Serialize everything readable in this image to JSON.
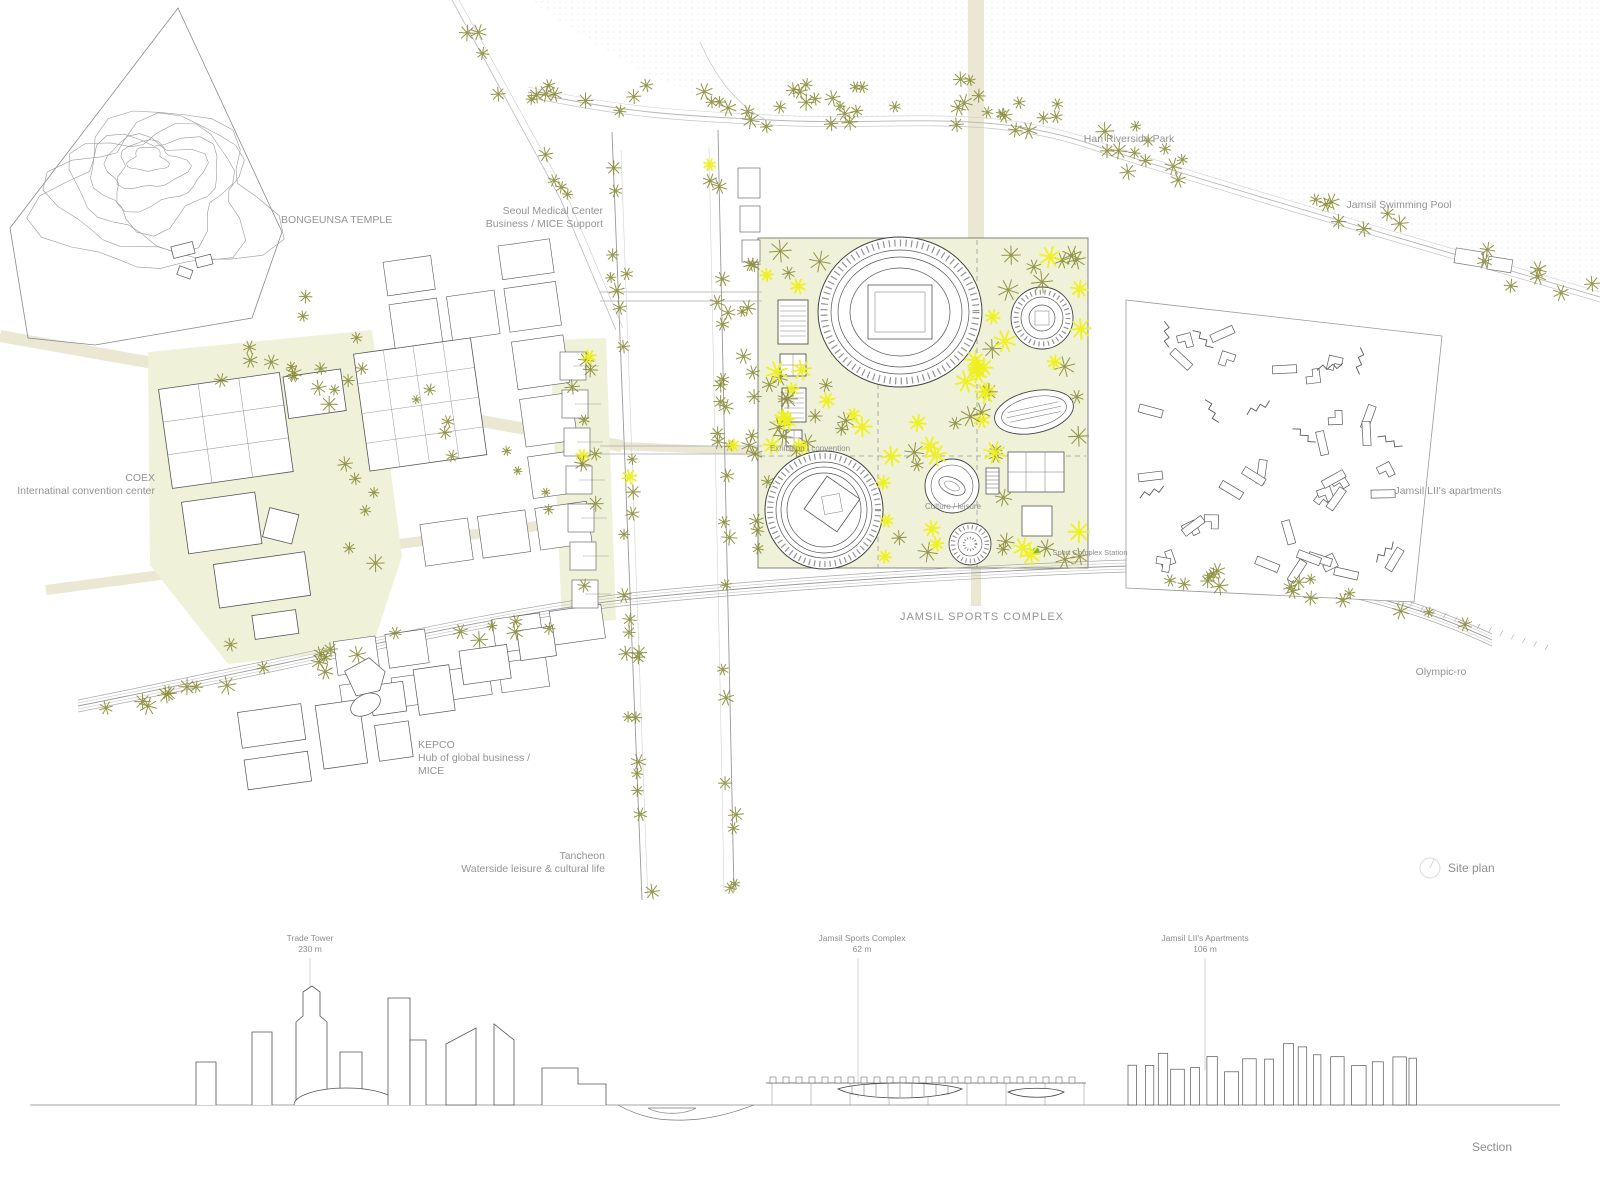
{
  "colors": {
    "tree_olive": "#8a8d3a",
    "tree_yellow": "#eef01c",
    "zone_green": "#eff2d8",
    "road_beige": "#eae7d3",
    "station_green": "#6fae3f",
    "line_gray": "#5a5a5a",
    "label_gray": "#949494"
  },
  "plan": {
    "labels": {
      "bongeunsa": "BONGEUNSA TEMPLE",
      "seoul_medical_line1": "Seoul Medical Center",
      "seoul_medical_line2": "Business / MICE Support",
      "coex_line1": "COEX",
      "coex_line2": "Internatinal convention center",
      "kepco_line1": "KEPCO",
      "kepco_line2": "Hub of global business /",
      "kepco_line3": "MICE",
      "tancheon_line1": "Tancheon",
      "tancheon_line2": "Waterside leisure & cultural life",
      "han_park": "Han Riverside Park",
      "swimming_pool": "Jamsil Swimming Pool",
      "apartments": "Jamsil LII's apartments",
      "sports_complex": "JAMSIL SPORTS COMPLEX",
      "olympic_ro": "Olympic-ro",
      "exhibition": "Exhibition / convention",
      "culture": "Culture / leisure",
      "station": "Sport Complex Station",
      "site_plan": "Site plan"
    }
  },
  "section": {
    "labels": {
      "trade_tower_name": "Trade Tower",
      "trade_tower_height": "230 m",
      "sports_name": "Jamsil Sports Complex",
      "sports_height": "62 m",
      "apartments_name": "Jamsil LII's Apartments",
      "apartments_height": "106 m",
      "caption": "Section"
    }
  }
}
